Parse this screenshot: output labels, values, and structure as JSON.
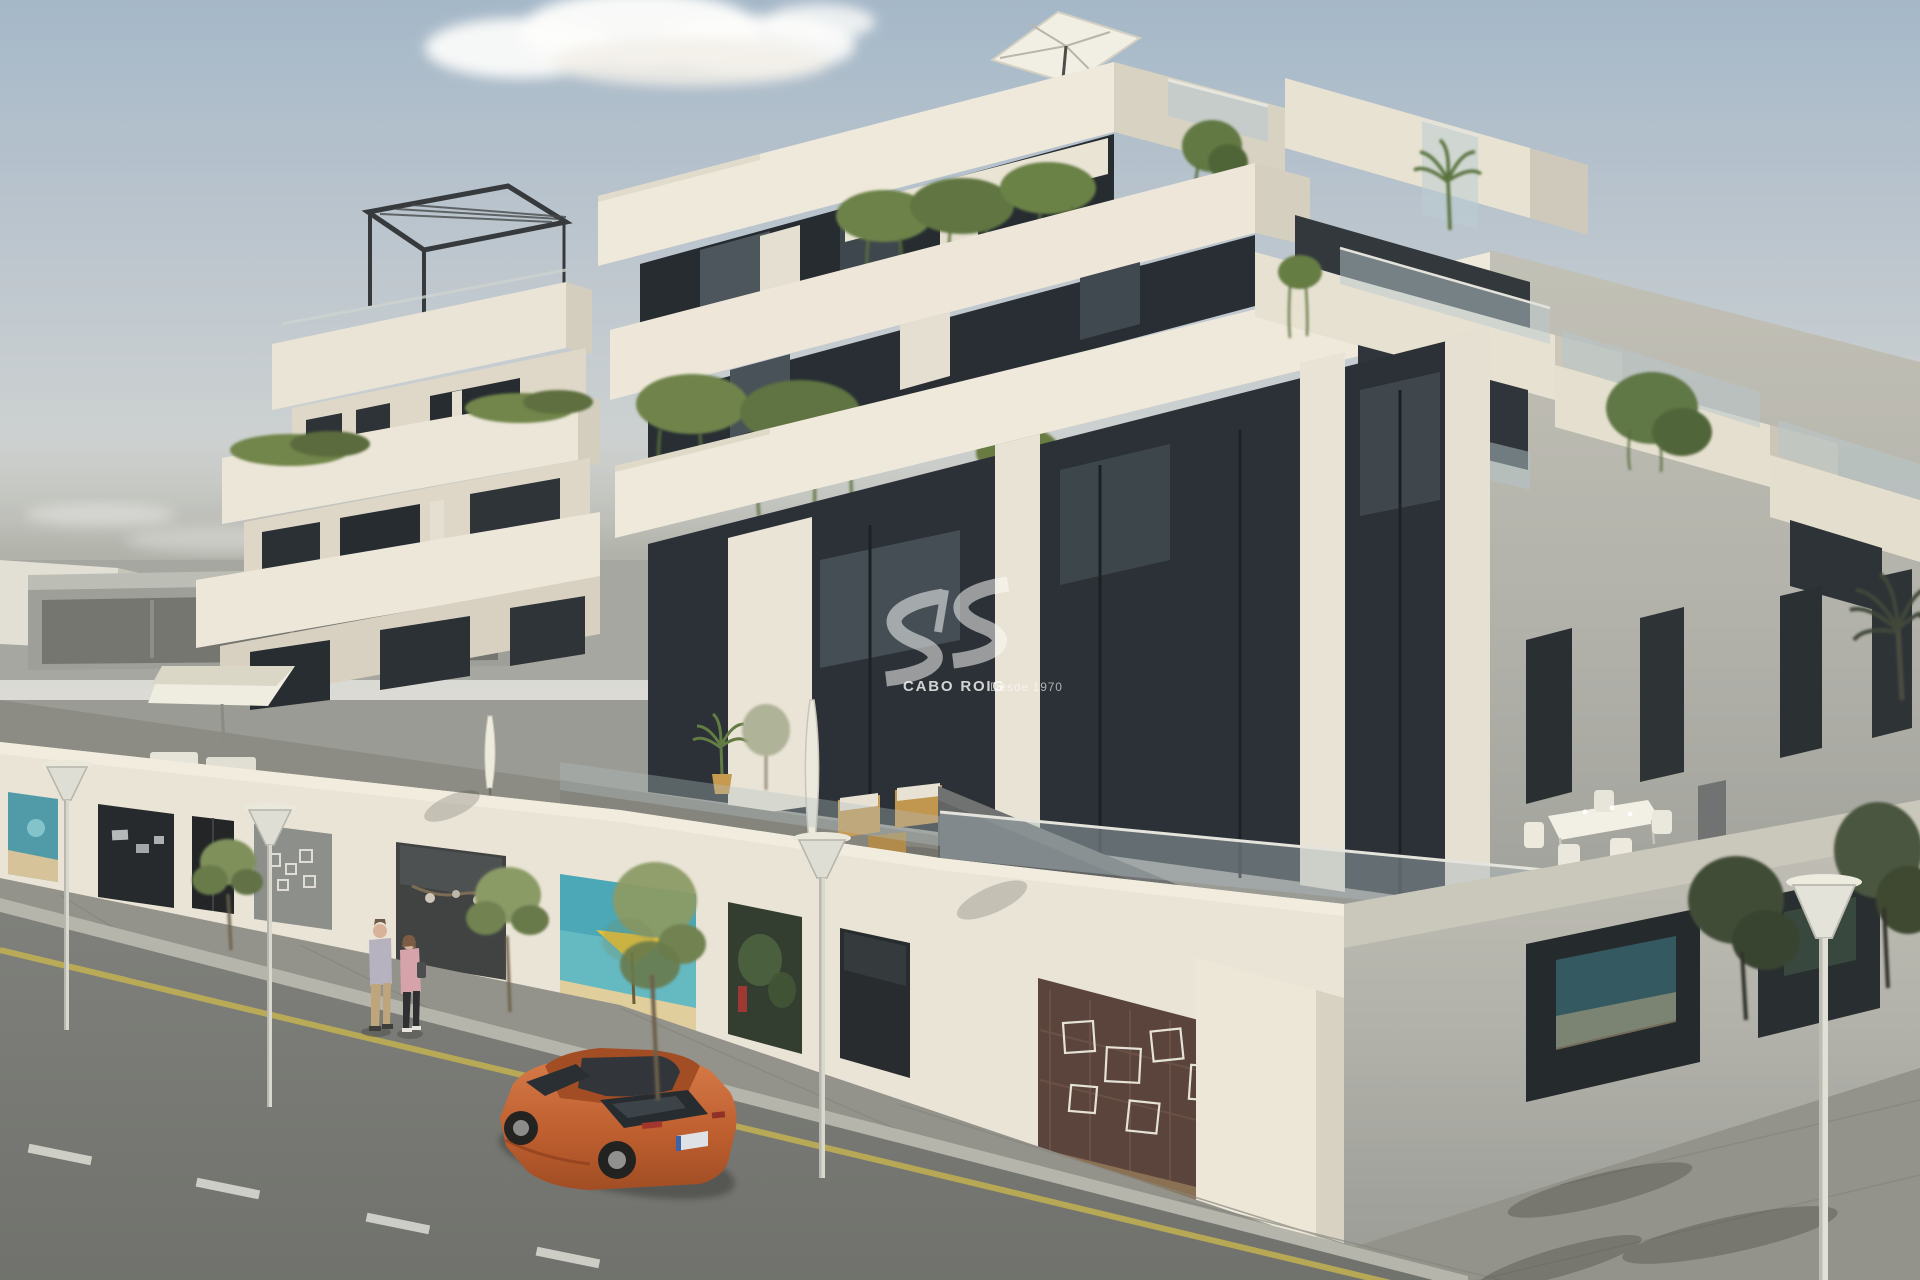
{
  "scene": {
    "type": "3d-architectural-render",
    "subject": "Modern white apartment complex with stepped terraces, hanging planters, ground-floor shop windows and a street corner",
    "sky": "pale blue sky with one small cloud",
    "vehicle": "orange hatchback parked at the kerb",
    "pedestrians": "couple walking on the pavement"
  },
  "watermark": {
    "logo": "sis-wave-logo",
    "brand": "CABO ROIG",
    "tagline": "Desde 1970"
  },
  "colors": {
    "sky_top": "#a5b8cb",
    "sky_horizon": "#d8d9d5",
    "facade_sunlit": "#efe9dc",
    "facade_shade": "#d5cfc1",
    "glass_dark": "#262c33",
    "balustrade_glass": "#aabec4",
    "terrace_floor": "#8e8e88",
    "road": "#757672",
    "sidewalk": "#92928c",
    "kerb": "#b5b5ad",
    "marking_yellow": "#c9b64f",
    "marking_white": "#d9d9d4",
    "car_body": "#c4602f",
    "foliage": "#6a8046",
    "watermark_white": "rgba(255,255,255,0.55)"
  },
  "shops": [
    {
      "display": "beach mural"
    },
    {
      "display": "gallery pieces"
    },
    {
      "display": "entrance door"
    },
    {
      "display": "geometric display"
    },
    {
      "display": "branch mobile sculpture"
    },
    {
      "display": "beach parasol scene"
    },
    {
      "display": "moss wall with red accent"
    },
    {
      "display": "dark display"
    },
    {
      "display": "wireframe cubes on brick wall"
    },
    {
      "display": "coastal artwork"
    }
  ]
}
